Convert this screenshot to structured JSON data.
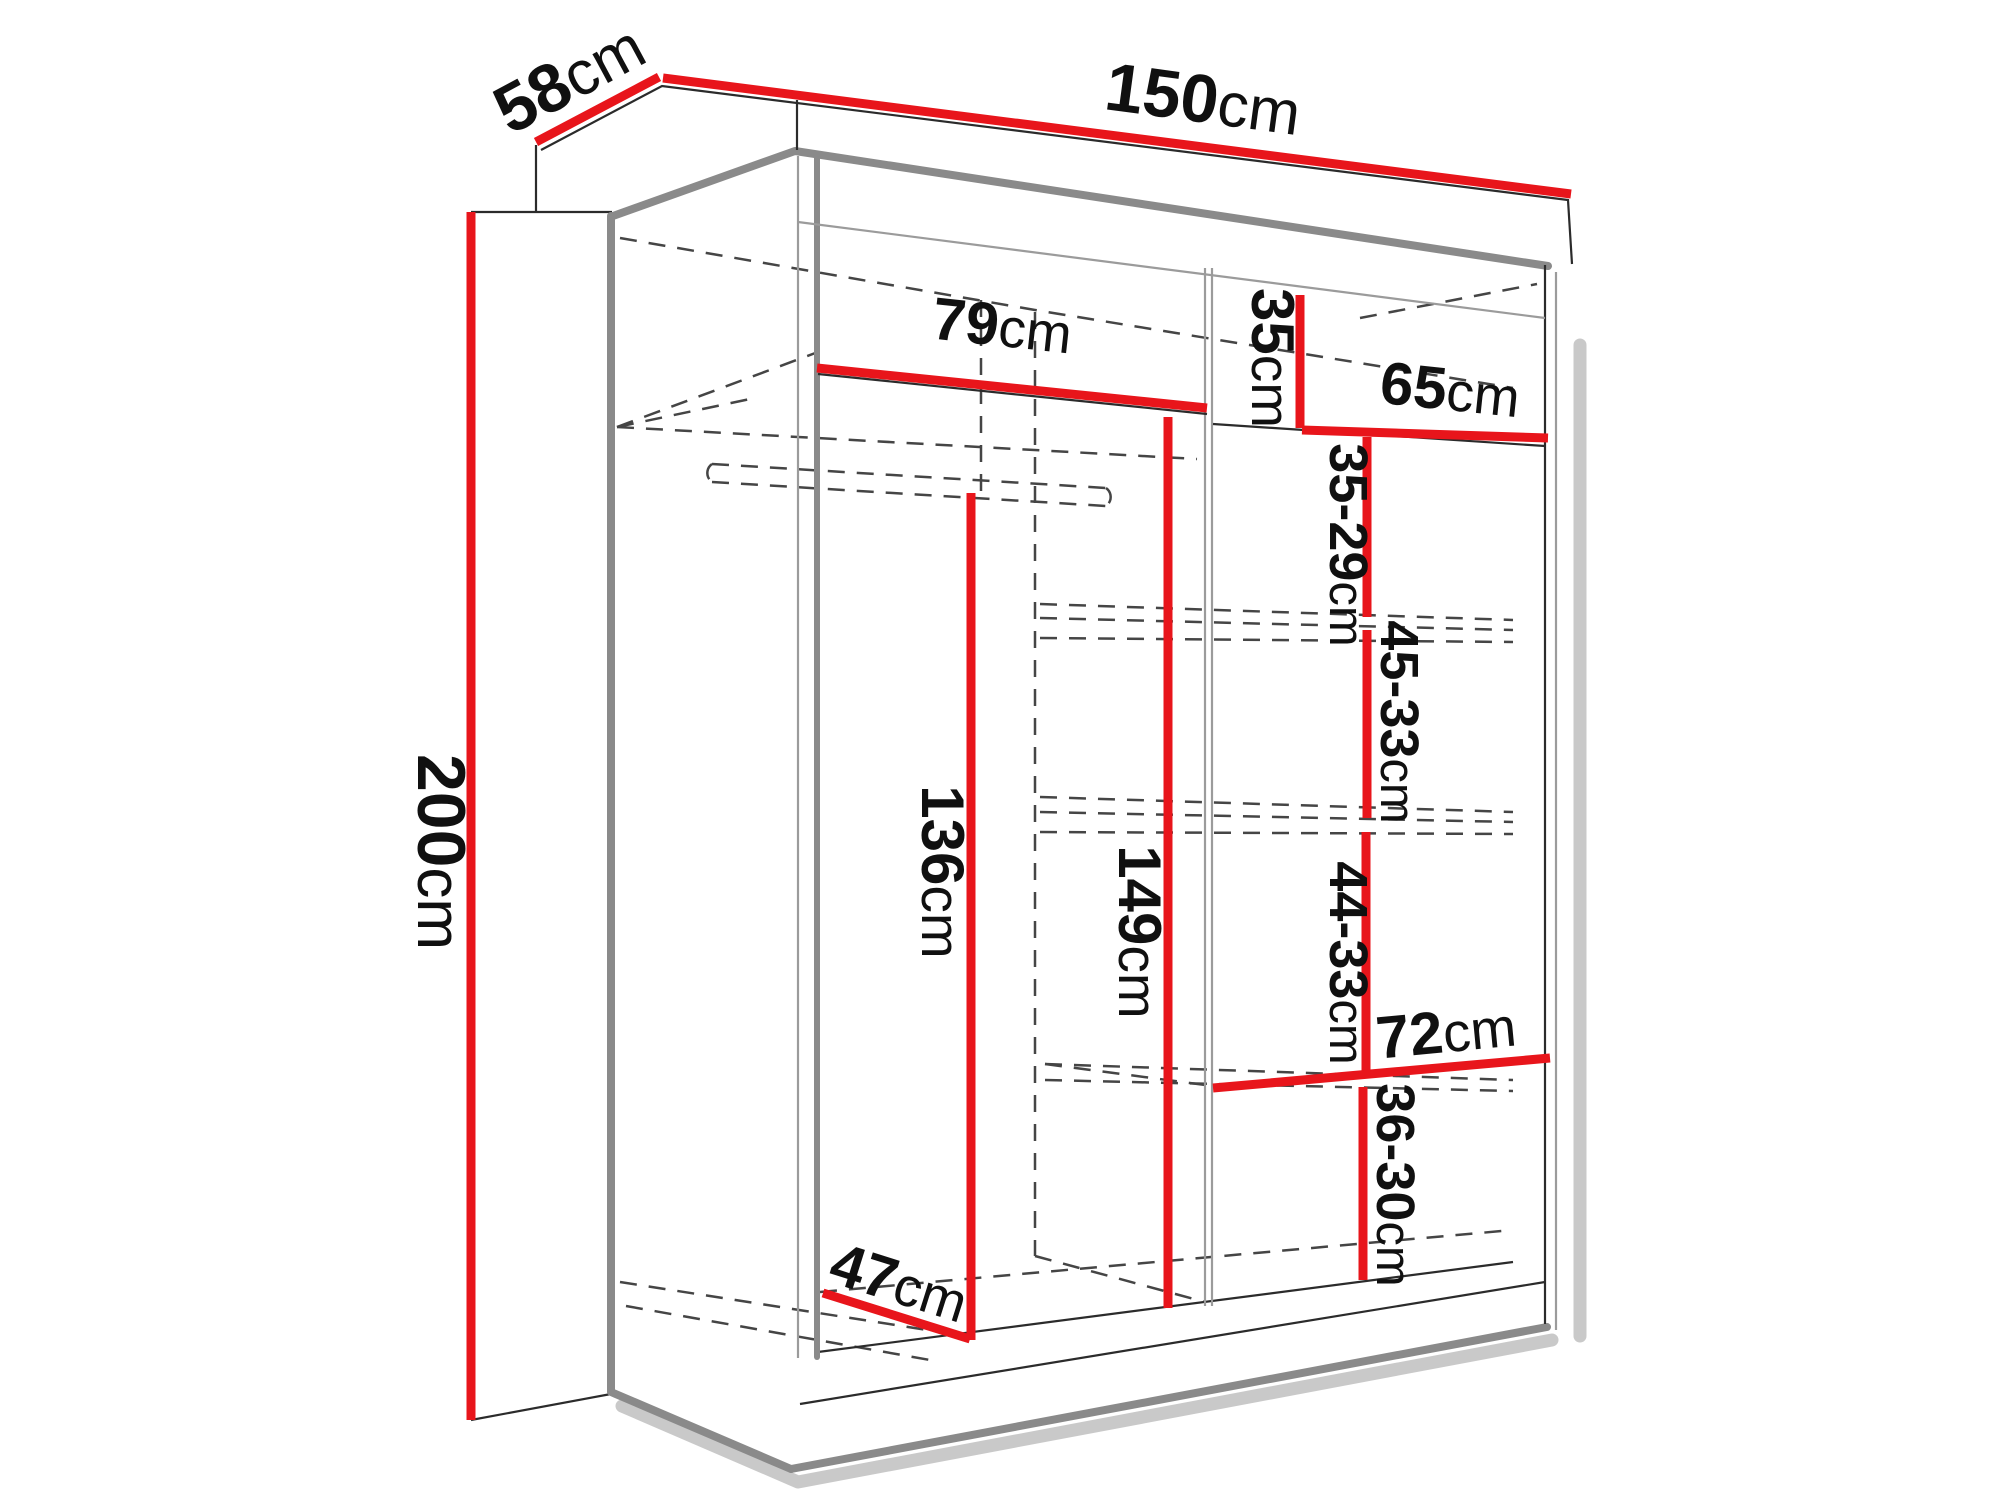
{
  "diagram": {
    "kind": "wardrobe-dimension-diagram",
    "unit": "cm",
    "colors": {
      "dimension_line": "#e8151b",
      "outline": "#8a8a8a",
      "hidden_edge": "#454545",
      "label_text": "#101010",
      "background": "#ffffff"
    },
    "dimensions": {
      "width": {
        "value": "150",
        "unit": "cm"
      },
      "depth": {
        "value": "58",
        "unit": "cm"
      },
      "height": {
        "value": "200",
        "unit": "cm"
      },
      "left_shelf_width": {
        "value": "79",
        "unit": "cm"
      },
      "top_right_cubby_height": {
        "value": "35",
        "unit": "cm"
      },
      "right_shelf_width": {
        "value": "65",
        "unit": "cm"
      },
      "right_gap_upper": {
        "value": "35-29",
        "unit": "cm"
      },
      "right_gap_middle": {
        "value": "45-33",
        "unit": "cm"
      },
      "right_gap_lower": {
        "value": "44-33",
        "unit": "cm"
      },
      "bottom_right_shelf_width": {
        "value": "72",
        "unit": "cm"
      },
      "bottom_right_gap": {
        "value": "36-30",
        "unit": "cm"
      },
      "left_hanging_height": {
        "value": "136",
        "unit": "cm"
      },
      "center_interior_height": {
        "value": "149",
        "unit": "cm"
      },
      "floor_depth": {
        "value": "47",
        "unit": "cm"
      }
    }
  }
}
